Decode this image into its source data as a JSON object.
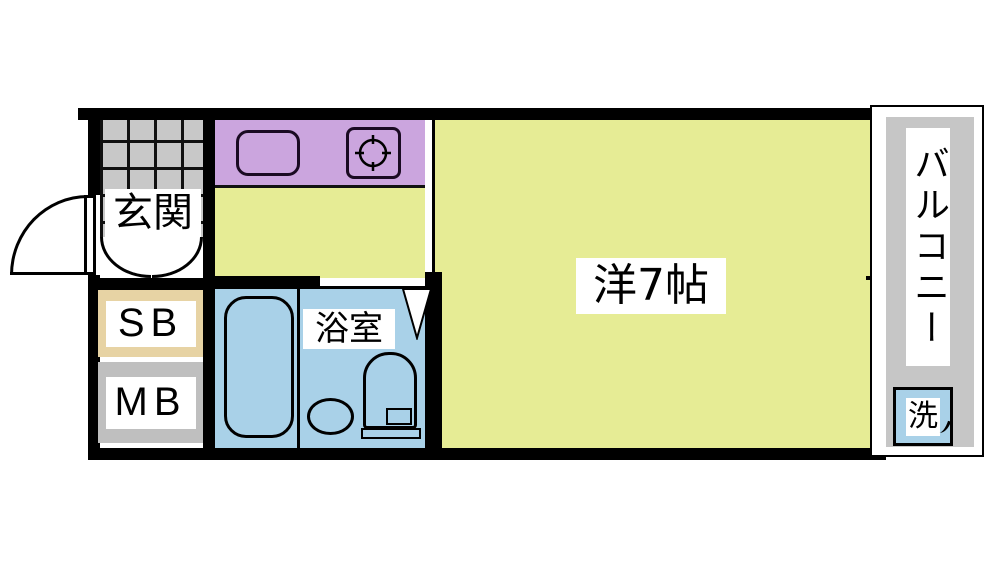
{
  "floorplan": {
    "labels": {
      "genkan": "玄関",
      "shoe_box": "SB",
      "meter_box": "MB",
      "bathroom": "浴室",
      "main_room": "洋7帖",
      "balcony": "バルコニー",
      "washer": "洗"
    },
    "colors": {
      "wall": "#000000",
      "room_floor": "#e6ec95",
      "kitchen_counter": "#cba5de",
      "bathroom_floor": "#a9d1e8",
      "balcony_floor": "#c6c6c6",
      "shoe_box": "#e7d3a4",
      "meter_box": "#bfbfbf",
      "genkan_tile": "#c8c8c8",
      "label_background": "#ffffff"
    }
  }
}
